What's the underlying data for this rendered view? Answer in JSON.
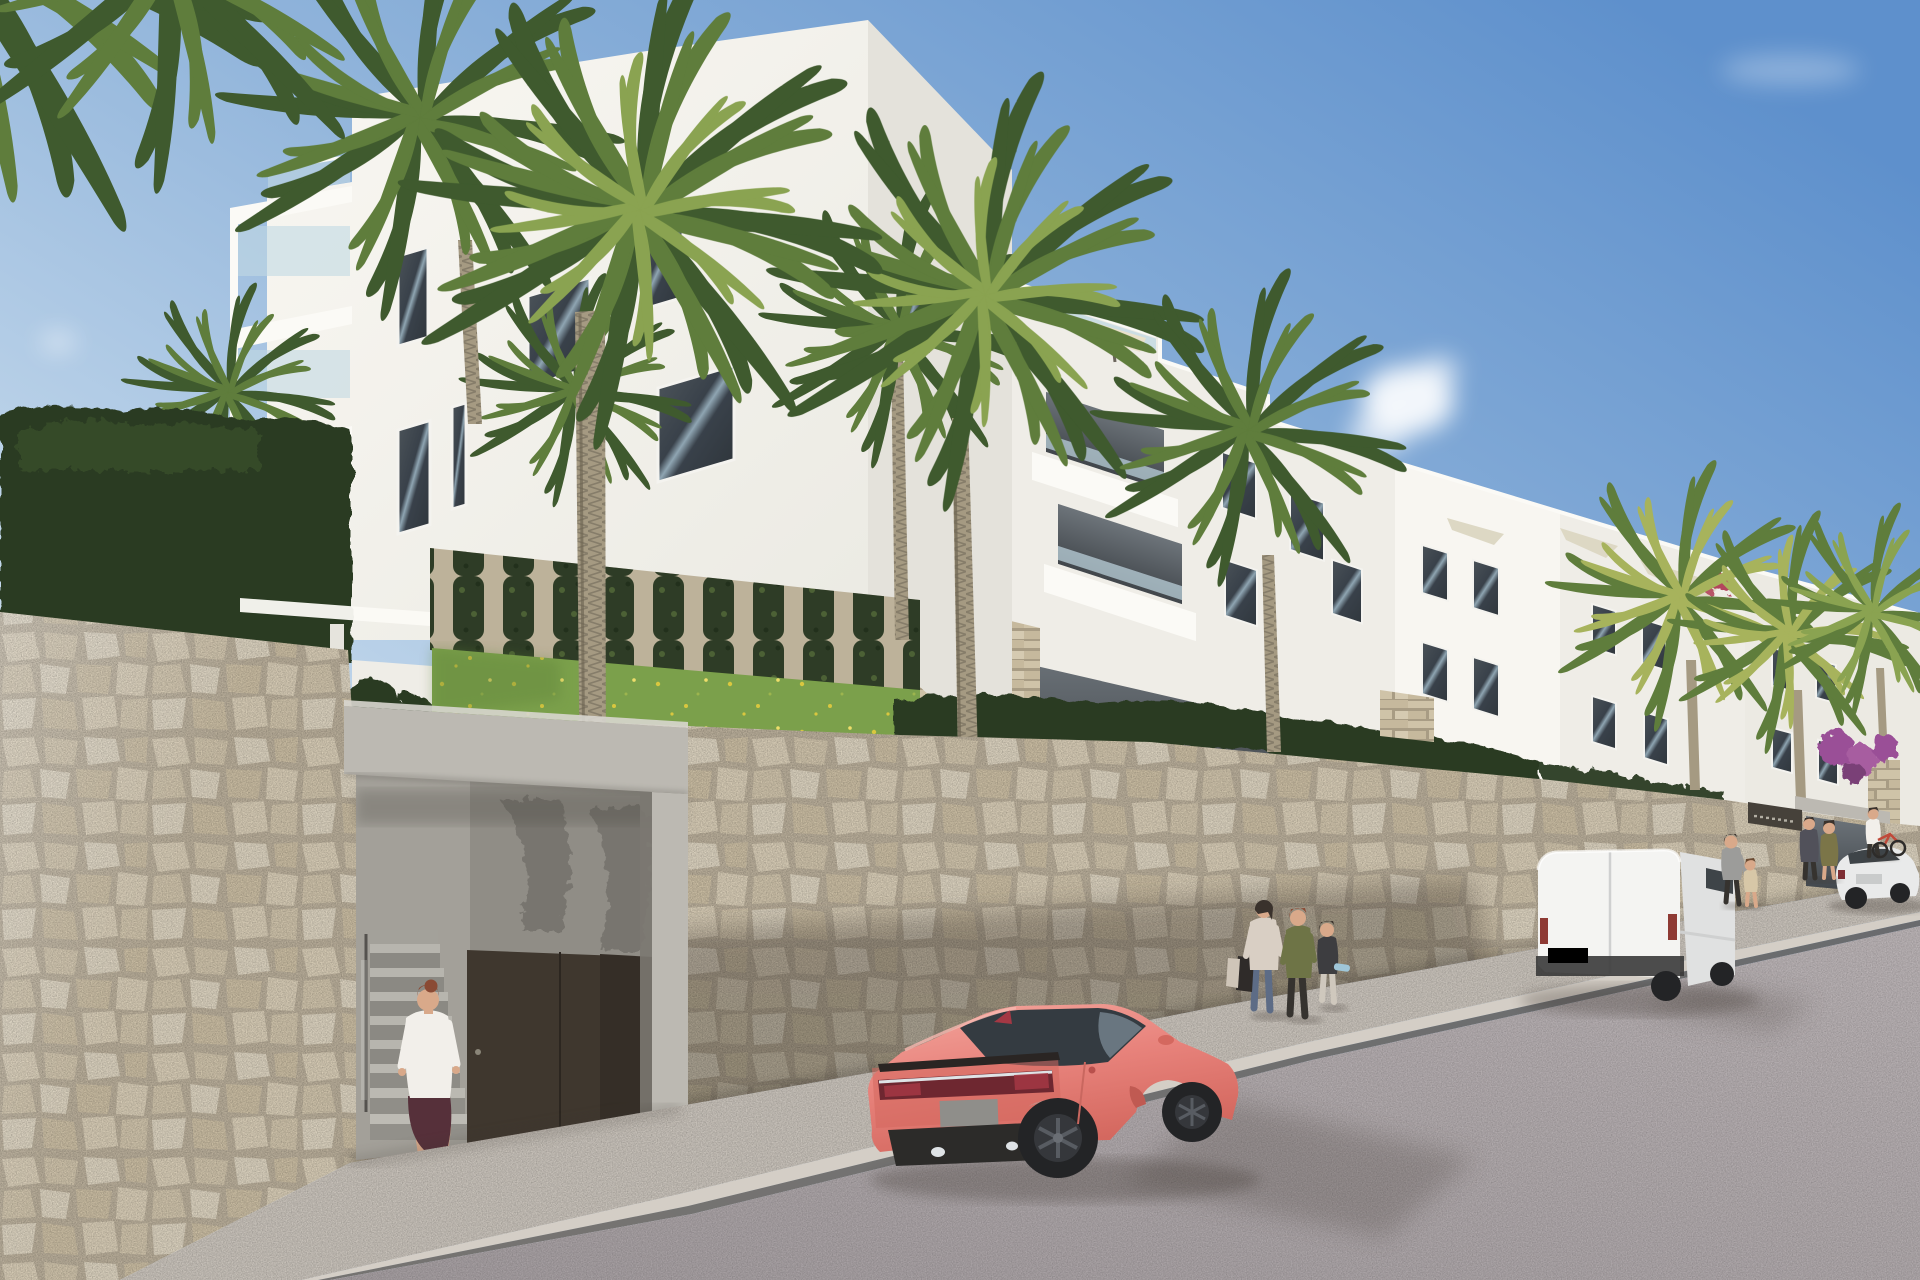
{
  "scene": {
    "kind": "3d-architectural-render",
    "setting": "modern white apartment complex on a hillside street with stone retaining wall, palm trees, parked vehicles and pedestrians",
    "sky": "clear blue, small soft clouds",
    "text_visible": false,
    "sign": {
      "style": "dark rectangular plaque with small illegible light lettering on gate wall",
      "text": ""
    },
    "counts": {
      "people": 9,
      "vehicles": 3,
      "palm_crowns": 11,
      "buildings": 4
    }
  },
  "palette": {
    "sky-top": "#5e90cc",
    "sky-mid": "#8fb3da",
    "sky-low": "#cfdfee",
    "cloud-white": "#ffffff",
    "bldg-bright": "#f8f6f1",
    "bldg-light": "#efede7",
    "bldg-mid": "#e4e2db",
    "bldg-far": "#eceae3",
    "parapet-white": "#fbfaf6",
    "recess-top": "#6d747a",
    "recess-bot": "#41464b",
    "glass-blue": "#c2d8e2",
    "win-dark": "#3a4147",
    "win-hi": "#93a8b4",
    "frame-white": "#f4f3ef",
    "umbrella-cream": "#e9e1cb",
    "sail-cream": "#ddd8c4",
    "palm-dark": "#3f5a2e",
    "palm-mid": "#5f7d3c",
    "palm-light": "#8aa351",
    "palm-sun": "#a7b35c",
    "trunk-light": "#a59a82",
    "trunk-dark": "#6f6654",
    "hedge-dark": "#2c3a24",
    "hedge-mid": "#4c6836",
    "ivy-green": "#2e3c26",
    "ivy-light": "#4c6135",
    "ivy-wall-back": "#bdb29a",
    "grass-green": "#7ba04b",
    "grass-dark": "#5d8039",
    "flower-yellow": "#d9c73f",
    "stone-mortar": "#b8ad99",
    "stone-a": "#d5cab4",
    "stone-b": "#cdc1a9",
    "stone-c": "#d9d0bd",
    "stone-d": "#c8bba1",
    "ledge-bg": "#a89c84",
    "ledge-a": "#cfc3a8",
    "ledge-b": "#c6b99d",
    "concrete-light": "#bcb9b2",
    "concrete-mid": "#a5a29b",
    "concrete-shade": "#908d86",
    "concrete-dark": "#7b7871",
    "door-brown": "#3f372e",
    "sidewalk-grey": "#c7c1b9",
    "curb-light": "#d4cec6",
    "curb-dark": "#645f5a",
    "road-grey": "#b6afb1",
    "road-dark": "#a19a9c",
    "shadow-tint": "#3c362f",
    "car-pink": "#e8837c",
    "car-pink-light": "#f4a79e",
    "car-pink-dark": "#d4685f",
    "car-glass": "#343b41",
    "tail-dark": "#6e2730",
    "tail-red": "#a43844",
    "chrome": "#dfe3e6",
    "wheel-dark": "#232426",
    "rim-grey": "#585c62",
    "diffuser": "#2c2b29",
    "van-white": "#f4f4f2",
    "van-side": "#e0e1e1",
    "van-trim": "#3a3a3a",
    "sedan-white": "#e9eaea",
    "sedan-glass": "#3e4448",
    "skin": "#d9a98a",
    "hair-auburn": "#8a4a34",
    "hair-dark": "#3a322c",
    "blouse-white": "#f2efea",
    "skirt-plum": "#56303a",
    "floral-top": "#d9cfc4",
    "jeans": "#5d6c86",
    "bag-dark": "#2f2b29",
    "olive-jacket": "#6e7446",
    "pants-dark": "#36332f",
    "child-top": "#3d3d40",
    "child-pants": "#cfc8bd",
    "skate-blue": "#9fc6d8",
    "tee-grey": "#9c9c9a",
    "beige-kid": "#d7c7a7",
    "jacket-grey": "#51515a",
    "dress-olive": "#7b7548",
    "bike-red": "#c04a3a",
    "boug-purple": "#9a4f97",
    "boug-red": "#b3455c",
    "sign-dark": "#46413a"
  }
}
